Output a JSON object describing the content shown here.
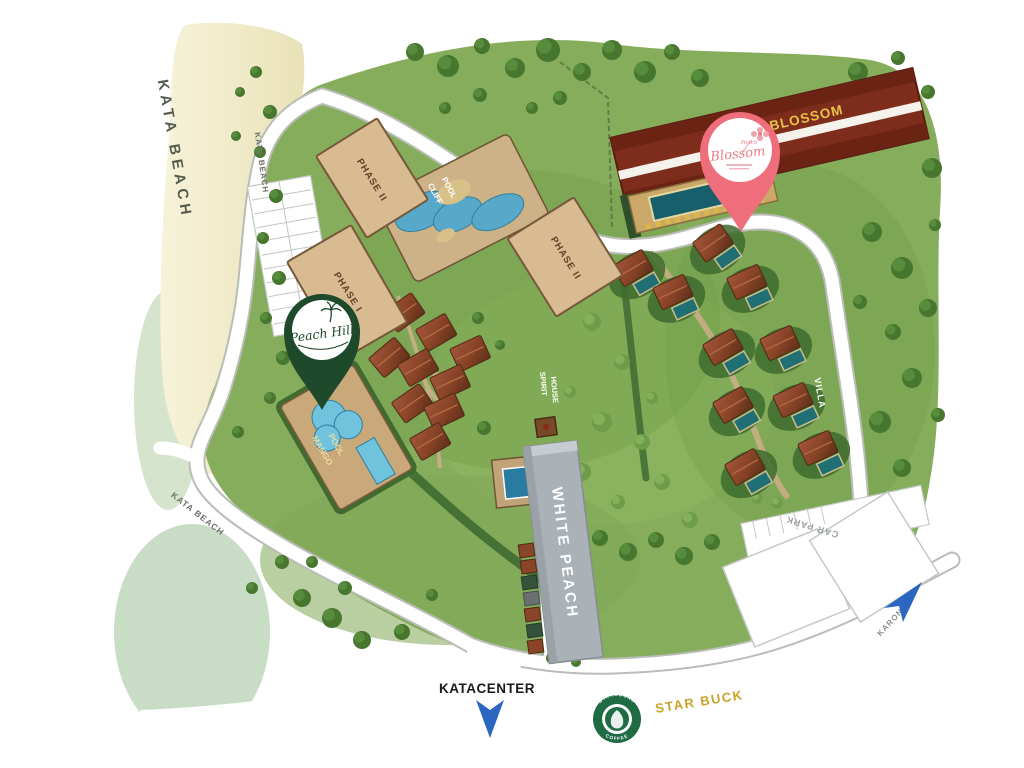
{
  "map": {
    "beach": {
      "label": "KATA BEACH"
    },
    "roads": {
      "kata_beach_upper": "KATA BEACH",
      "kata_beach_lower": "KATA BEACH",
      "karon": "KARON",
      "katacenter": "KATACENTER"
    },
    "buildings": {
      "phase2_north": "PHASE II",
      "phase2_east": "PHASE II",
      "phase1": "PHASE I",
      "peach_blossom": "PEACH BLOSSOM",
      "white_peach": "WHITE PEACH"
    },
    "pools": {
      "cliff_line1": "CLIFF",
      "cliff_line2": "POOL",
      "mango_line1": "MANGO",
      "mango_line2": "POOL"
    },
    "areas": {
      "villa": "VILLA",
      "car_park": "CAR PARK",
      "spirit_line1": "SPIRIT",
      "spirit_line2": "HOUSE"
    },
    "pins": {
      "peach_hill": {
        "label": "Peach Hill",
        "color": "#1e4a2b"
      },
      "blossom": {
        "label": "Blossom",
        "small": "Peach",
        "color": "#ee6e7b"
      }
    },
    "poi": {
      "starbucks_name": "STAR BUCK",
      "starbucks_ring_top": "STARBUCKS",
      "starbucks_ring_bottom": "COFFEE"
    }
  },
  "colors": {
    "starbucks_green": "#1e6b44",
    "arrow_blue": "#2b66c0",
    "gold_text": "#c9a227",
    "blossom_gold": "#e8c24a",
    "building_red": "#7e2d1c"
  }
}
